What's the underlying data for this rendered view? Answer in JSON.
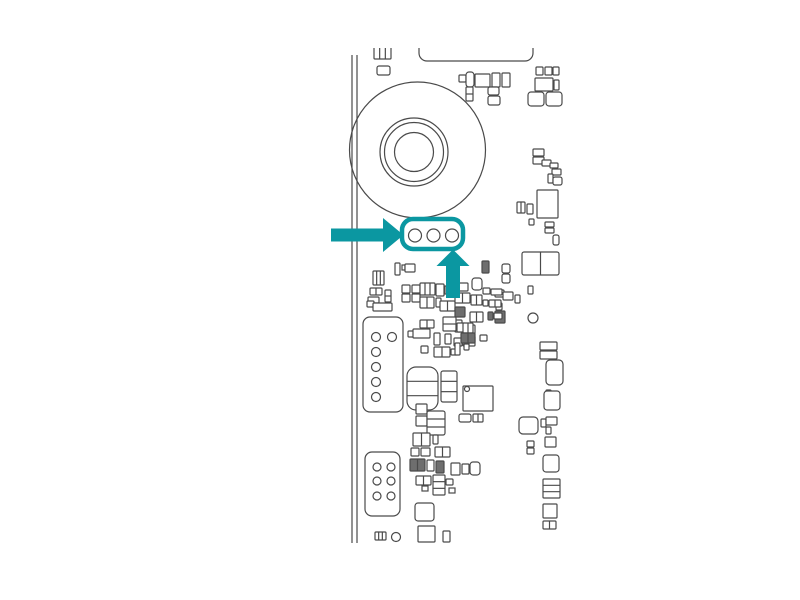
{
  "meta": {
    "title": "Circuit board callout illustration",
    "description": "Black-and-white line drawing of a printed circuit board; a teal arrow and teal rounded outline highlight a three-pin connector below a large circular speaker/camera component."
  },
  "canvas": {
    "width": 800,
    "height": 600,
    "background": "#ffffff"
  },
  "palette": {
    "outline": "#4a4a4a",
    "component_fill": "#ffffff",
    "dark_fill": "#6e6e6e",
    "accent": "#0b97a1"
  },
  "illustration": {
    "clip": {
      "x": 336,
      "y": 48,
      "width": 234,
      "height": 498
    },
    "board_edge_lines": [
      {
        "x": 352,
        "y1": 55,
        "y2": 543
      },
      {
        "x": 357,
        "y1": 55,
        "y2": 543
      }
    ],
    "top_panel": {
      "x": 419,
      "y": 30,
      "w": 114,
      "h": 31,
      "rx": 8
    },
    "speaker_rings": [
      {
        "cx": 417.5,
        "cy": 150,
        "r": 68
      },
      {
        "cx": 414,
        "cy": 152,
        "r": 34
      },
      {
        "cx": 414,
        "cy": 152,
        "r": 29.5
      },
      {
        "cx": 414,
        "cy": 152,
        "r": 19.5
      }
    ],
    "rect_format": [
      "x",
      "y",
      "w",
      "h",
      "rx",
      "dividers_v",
      "dividers_h",
      "dark"
    ],
    "rects": [
      [
        374,
        44,
        17,
        15,
        1,
        2,
        0,
        0
      ],
      [
        377,
        66,
        13,
        9,
        2,
        0,
        0,
        0
      ],
      [
        459,
        75,
        7,
        7,
        1,
        0,
        0,
        0
      ],
      [
        466,
        72,
        8,
        15,
        3,
        0,
        0,
        0
      ],
      [
        475,
        74,
        15,
        13,
        1,
        0,
        0,
        0
      ],
      [
        492,
        73,
        8,
        14,
        1,
        0,
        0,
        0
      ],
      [
        502,
        73,
        8,
        14,
        1,
        0,
        0,
        0
      ],
      [
        466,
        87,
        7,
        14,
        1,
        0,
        1,
        0
      ],
      [
        488,
        87,
        11,
        8,
        2,
        0,
        0,
        0
      ],
      [
        488,
        96,
        12,
        9,
        2,
        0,
        0,
        0
      ],
      [
        536,
        67,
        7,
        8,
        1,
        0,
        0,
        0
      ],
      [
        545,
        67,
        7,
        8,
        1,
        0,
        0,
        0
      ],
      [
        553,
        67,
        6,
        8,
        1,
        0,
        0,
        0
      ],
      [
        535,
        78,
        18,
        13,
        1,
        0,
        0,
        0
      ],
      [
        554,
        80,
        5,
        10,
        1,
        0,
        0,
        0
      ],
      [
        528,
        92,
        16,
        14,
        3,
        0,
        0,
        0
      ],
      [
        546,
        92,
        16,
        14,
        3,
        0,
        0,
        0
      ],
      [
        533,
        149,
        11,
        7,
        1,
        0,
        0,
        0
      ],
      [
        533,
        157,
        11,
        7,
        1,
        0,
        0,
        0
      ],
      [
        542,
        160,
        9,
        6,
        1,
        0,
        0,
        0
      ],
      [
        550,
        163,
        8,
        5,
        1,
        0,
        0,
        0
      ],
      [
        552,
        169,
        9,
        6,
        1,
        0,
        0,
        0
      ],
      [
        548,
        174,
        5,
        9,
        1,
        0,
        0,
        0
      ],
      [
        553,
        177,
        9,
        8,
        2,
        0,
        0,
        0
      ],
      [
        537,
        190,
        21,
        28,
        1,
        0,
        0,
        0
      ],
      [
        517,
        202,
        8,
        11,
        1,
        1,
        0,
        0
      ],
      [
        527,
        204,
        6,
        10,
        1,
        0,
        0,
        0
      ],
      [
        529,
        219,
        5,
        6,
        1,
        0,
        0,
        0
      ],
      [
        545,
        222,
        9,
        5,
        1,
        0,
        0,
        0
      ],
      [
        545,
        228,
        9,
        5,
        1,
        0,
        0,
        0
      ],
      [
        553,
        235,
        6,
        10,
        2,
        0,
        0,
        0
      ],
      [
        522,
        252,
        37,
        23,
        2,
        1,
        0,
        0
      ],
      [
        502,
        264,
        8,
        9,
        2,
        0,
        0,
        0
      ],
      [
        502,
        274,
        8,
        9,
        2,
        0,
        0,
        0
      ],
      [
        528,
        286,
        5,
        8,
        1,
        0,
        0,
        0
      ],
      [
        495,
        290,
        9,
        7,
        1,
        0,
        0,
        0
      ],
      [
        496,
        303,
        6,
        7,
        1,
        0,
        0,
        0
      ],
      [
        495,
        311,
        10,
        12,
        1,
        0,
        0,
        1
      ],
      [
        540,
        342,
        17,
        8,
        1,
        0,
        0,
        0
      ],
      [
        540,
        351,
        17,
        8,
        1,
        0,
        0,
        0
      ],
      [
        546,
        360,
        17,
        25,
        4,
        0,
        0,
        0
      ],
      [
        546,
        390,
        5,
        5,
        1,
        0,
        0,
        0
      ],
      [
        544,
        391,
        16,
        19,
        3,
        0,
        0,
        0
      ],
      [
        519,
        417,
        19,
        17,
        4,
        0,
        0,
        0
      ],
      [
        541,
        419,
        5,
        8,
        1,
        0,
        0,
        0
      ],
      [
        546,
        417,
        11,
        8,
        1,
        0,
        0,
        0
      ],
      [
        546,
        427,
        5,
        7,
        1,
        0,
        0,
        0
      ],
      [
        527,
        441,
        7,
        6,
        1,
        0,
        0,
        0
      ],
      [
        527,
        448,
        7,
        6,
        1,
        0,
        0,
        0
      ],
      [
        545,
        437,
        11,
        10,
        1,
        0,
        0,
        0
      ],
      [
        543,
        455,
        16,
        17,
        3,
        0,
        0,
        0
      ],
      [
        543,
        479,
        17,
        19,
        1,
        0,
        2,
        0
      ],
      [
        543,
        504,
        14,
        14,
        1,
        0,
        0,
        0
      ],
      [
        543,
        521,
        13,
        8,
        1,
        1,
        0,
        0
      ],
      [
        395,
        263,
        5,
        12,
        1,
        0,
        0,
        0
      ],
      [
        402,
        265,
        3,
        5,
        0,
        0,
        0,
        0
      ],
      [
        405,
        264,
        10,
        8,
        1,
        0,
        0,
        0
      ],
      [
        373,
        271,
        11,
        14,
        1,
        2,
        0,
        0
      ],
      [
        370,
        288,
        12,
        7,
        1,
        1,
        0,
        0
      ],
      [
        368,
        297,
        11,
        6,
        1,
        0,
        0,
        0
      ],
      [
        385,
        290,
        6,
        12,
        1,
        0,
        1,
        0
      ],
      [
        402,
        285,
        8,
        8,
        1,
        0,
        0,
        0
      ],
      [
        412,
        285,
        8,
        8,
        1,
        0,
        0,
        0
      ],
      [
        402,
        294,
        8,
        8,
        1,
        0,
        0,
        0
      ],
      [
        412,
        294,
        8,
        8,
        1,
        0,
        0,
        0
      ],
      [
        367,
        301,
        7,
        6,
        1,
        0,
        0,
        0
      ],
      [
        373,
        303,
        19,
        8,
        1,
        0,
        0,
        0
      ],
      [
        420,
        283,
        15,
        12,
        1,
        2,
        0,
        0
      ],
      [
        436,
        284,
        8,
        12,
        1,
        0,
        0,
        0
      ],
      [
        445,
        286,
        3,
        8,
        0,
        0,
        0,
        0
      ],
      [
        420,
        297,
        14,
        11,
        1,
        1,
        0,
        0
      ],
      [
        436,
        298,
        5,
        9,
        1,
        0,
        0,
        0
      ],
      [
        440,
        301,
        15,
        10,
        1,
        1,
        0,
        0
      ],
      [
        482,
        261,
        7,
        12,
        1,
        0,
        0,
        1
      ],
      [
        472,
        278,
        10,
        12,
        3,
        0,
        0,
        0
      ],
      [
        455,
        283,
        13,
        8,
        1,
        0,
        0,
        0
      ],
      [
        483,
        288,
        7,
        6,
        1,
        0,
        0,
        0
      ],
      [
        491,
        289,
        11,
        6,
        1,
        0,
        0,
        0
      ],
      [
        455,
        293,
        15,
        10,
        1,
        1,
        0,
        0
      ],
      [
        471,
        295,
        11,
        10,
        1,
        1,
        0,
        0
      ],
      [
        483,
        300,
        5,
        6,
        1,
        0,
        0,
        0
      ],
      [
        489,
        300,
        12,
        7,
        1,
        1,
        0,
        0
      ],
      [
        503,
        292,
        10,
        8,
        1,
        0,
        0,
        0
      ],
      [
        515,
        295,
        5,
        8,
        1,
        0,
        0,
        0
      ],
      [
        455,
        307,
        10,
        10,
        1,
        0,
        0,
        1
      ],
      [
        470,
        312,
        13,
        10,
        1,
        1,
        0,
        0
      ],
      [
        488,
        312,
        5,
        8,
        1,
        0,
        0,
        1
      ],
      [
        494,
        313,
        8,
        6,
        1,
        0,
        0,
        0
      ],
      [
        455,
        320,
        7,
        12,
        1,
        0,
        0,
        0
      ],
      [
        420,
        320,
        14,
        8,
        1,
        1,
        0,
        0
      ],
      [
        443,
        317,
        13,
        14,
        1,
        0,
        1,
        0
      ],
      [
        457,
        323,
        8,
        9,
        1,
        0,
        0,
        0
      ],
      [
        470,
        325,
        5,
        9,
        1,
        0,
        0,
        0
      ],
      [
        463,
        323,
        10,
        10,
        1,
        1,
        0,
        0
      ],
      [
        408,
        331,
        6,
        6,
        1,
        0,
        0,
        0
      ],
      [
        413,
        329,
        17,
        9,
        1,
        0,
        0,
        0
      ],
      [
        434,
        333,
        6,
        12,
        1,
        0,
        0,
        0
      ],
      [
        445,
        334,
        6,
        10,
        1,
        0,
        0,
        0
      ],
      [
        454,
        338,
        8,
        8,
        1,
        0,
        0,
        0
      ],
      [
        463,
        336,
        12,
        10,
        1,
        1,
        0,
        0
      ],
      [
        461,
        333,
        14,
        10,
        1,
        1,
        0,
        1
      ],
      [
        480,
        335,
        7,
        6,
        1,
        0,
        0,
        0
      ],
      [
        421,
        346,
        7,
        7,
        1,
        0,
        0,
        0
      ],
      [
        434,
        347,
        16,
        10,
        1,
        1,
        0,
        0
      ],
      [
        451,
        349,
        6,
        6,
        1,
        0,
        0,
        0
      ],
      [
        464,
        344,
        5,
        6,
        1,
        0,
        0,
        0
      ],
      [
        455,
        343,
        5,
        12,
        1,
        0,
        0,
        0
      ],
      [
        407,
        367,
        31,
        43,
        9,
        0,
        2,
        0
      ],
      [
        441,
        371,
        16,
        31,
        2,
        0,
        2,
        0
      ],
      [
        416,
        404,
        11,
        10,
        1,
        0,
        0,
        0
      ],
      [
        416,
        416,
        11,
        10,
        1,
        0,
        0,
        0
      ],
      [
        427,
        411,
        18,
        24,
        2,
        0,
        2,
        0
      ],
      [
        463,
        386,
        30,
        25,
        1,
        0,
        0,
        0
      ],
      [
        459,
        414,
        12,
        8,
        2,
        0,
        0,
        0
      ],
      [
        473,
        414,
        10,
        8,
        1,
        1,
        0,
        0
      ],
      [
        413,
        433,
        17,
        13,
        1,
        1,
        0,
        0
      ],
      [
        433,
        435,
        5,
        9,
        1,
        0,
        0,
        0
      ],
      [
        411,
        448,
        8,
        8,
        1,
        0,
        0,
        0
      ],
      [
        421,
        448,
        9,
        8,
        1,
        0,
        0,
        0
      ],
      [
        435,
        447,
        15,
        10,
        1,
        1,
        0,
        0
      ],
      [
        410,
        459,
        15,
        12,
        1,
        1,
        0,
        1
      ],
      [
        427,
        460,
        7,
        11,
        1,
        0,
        0,
        0
      ],
      [
        436,
        461,
        8,
        12,
        1,
        0,
        0,
        1
      ],
      [
        451,
        463,
        9,
        12,
        1,
        0,
        0,
        0
      ],
      [
        462,
        464,
        7,
        10,
        1,
        0,
        0,
        0
      ],
      [
        470,
        462,
        10,
        13,
        3,
        0,
        0,
        0
      ],
      [
        416,
        476,
        15,
        9,
        1,
        1,
        0,
        0
      ],
      [
        422,
        486,
        6,
        5,
        0,
        0,
        0,
        0
      ],
      [
        433,
        475,
        12,
        20,
        1,
        0,
        2,
        0
      ],
      [
        446,
        479,
        7,
        6,
        1,
        0,
        0,
        0
      ],
      [
        449,
        488,
        6,
        5,
        0,
        0,
        0,
        0
      ],
      [
        415,
        503,
        19,
        18,
        3,
        0,
        0,
        0
      ],
      [
        375,
        532,
        11,
        8,
        1,
        2,
        0,
        0
      ],
      [
        418,
        526,
        17,
        16,
        1,
        0,
        0,
        0
      ],
      [
        443,
        531,
        7,
        11,
        1,
        0,
        0,
        0
      ]
    ],
    "connectors": [
      {
        "name": "connector-upper-left",
        "rect": {
          "x": 363,
          "y": 317,
          "w": 40,
          "h": 95,
          "rx": 7
        },
        "hole_r": 4.5,
        "holes": [
          [
            376,
            337
          ],
          [
            392,
            337
          ],
          [
            376,
            352
          ],
          [
            376,
            367
          ],
          [
            376,
            382
          ],
          [
            376,
            397
          ]
        ]
      },
      {
        "name": "connector-lower-left",
        "rect": {
          "x": 365,
          "y": 452,
          "w": 35,
          "h": 64,
          "rx": 7
        },
        "hole_r": 4,
        "holes": [
          [
            377,
            467
          ],
          [
            391,
            467
          ],
          [
            377,
            481
          ],
          [
            391,
            481
          ],
          [
            377,
            496
          ],
          [
            391,
            496
          ]
        ]
      }
    ],
    "loose_circles": [
      {
        "cx": 533,
        "cy": 318,
        "r": 5
      },
      {
        "cx": 396,
        "cy": 537,
        "r": 4.5
      },
      {
        "cx": 467,
        "cy": 389,
        "r": 2.5
      }
    ]
  },
  "callout": {
    "highlight_box": {
      "x": 402,
      "y": 219,
      "w": 61,
      "h": 30,
      "rx": 11,
      "stroke_width": 4.5
    },
    "pin_r": 6.5,
    "pins": [
      [
        415,
        235.5
      ],
      [
        433.5,
        235.5
      ],
      [
        452,
        235.5
      ]
    ],
    "arrow_left_points": "331,228.5 383,228.5 383,218 403.5,235 383,252 383,241.5 331,241.5",
    "arrow_up_points": "453,249.5 469.5,266 460,266 460,298 446,298 446,266 436.5,266"
  }
}
